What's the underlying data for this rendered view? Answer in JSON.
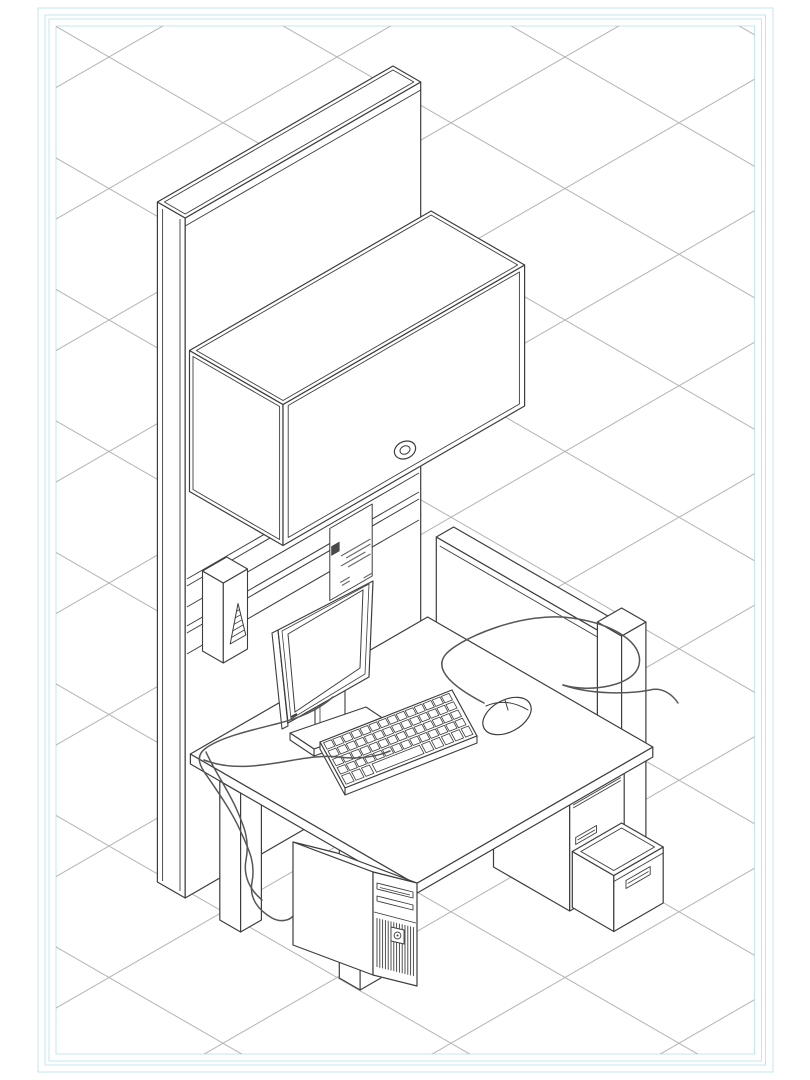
{
  "canvas": {
    "width": 810,
    "height": 1080,
    "background": "#ffffff"
  },
  "sheet_frame": {
    "line_color": "#c4e6ef",
    "rects": [
      [
        38,
        8,
        735,
        1064
      ],
      [
        45,
        15,
        720.5,
        1050
      ],
      [
        49,
        19,
        712.5,
        1042
      ],
      [
        56,
        26,
        698.5,
        1028
      ]
    ]
  },
  "grid": {
    "type": "isometric",
    "line_color": "#b6b6b6",
    "tile_width": 228,
    "tile_height": 131.5,
    "origin_x": 109,
    "origin_y": 57
  },
  "drawing": {
    "description": "Isometric CAD line drawing of an office cubicle workstation: tall end panel with slatwall rails, locked overhead flipper-door cabinet, hanging spec tag, rail-mounted accessory box, work surface on post legs with LCD monitor, keyboard, mouse and cables, computer tower below, box/box/file pedestal with an open file drawer, and a low privacy screen with end post.",
    "line_color": "#3d3d3d",
    "detail_line_color": "#6a6a6a",
    "cable_color": "#565656",
    "fill_color": "#ffffff",
    "parts": [
      {
        "id": "tall-end-panel",
        "label": "Tall end panel"
      },
      {
        "id": "slatwall-rails",
        "label": "Slatwall rails"
      },
      {
        "id": "hanging-tag",
        "label": "Hanging spec tag"
      },
      {
        "id": "rail-accessory-box",
        "label": "Rail accessory box"
      },
      {
        "id": "overhead-cabinet",
        "label": "Overhead cabinet"
      },
      {
        "id": "cabinet-lock",
        "label": "Cabinet lock"
      },
      {
        "id": "privacy-screen",
        "label": "Privacy screen"
      },
      {
        "id": "screen-end-post",
        "label": "Screen end post"
      },
      {
        "id": "pedestal",
        "label": "Box/box/file pedestal"
      },
      {
        "id": "desk-legs",
        "label": "Desk legs"
      },
      {
        "id": "work-surface",
        "label": "Work surface"
      },
      {
        "id": "file-drawer-open",
        "label": "Open file drawer"
      },
      {
        "id": "computer-tower",
        "label": "Computer tower"
      },
      {
        "id": "monitor-stand",
        "label": "Monitor stand"
      },
      {
        "id": "lcd-monitor",
        "label": "LCD monitor"
      },
      {
        "id": "keyboard",
        "label": "Keyboard"
      },
      {
        "id": "mouse",
        "label": "Mouse"
      },
      {
        "id": "cables",
        "label": "Cables"
      }
    ]
  }
}
